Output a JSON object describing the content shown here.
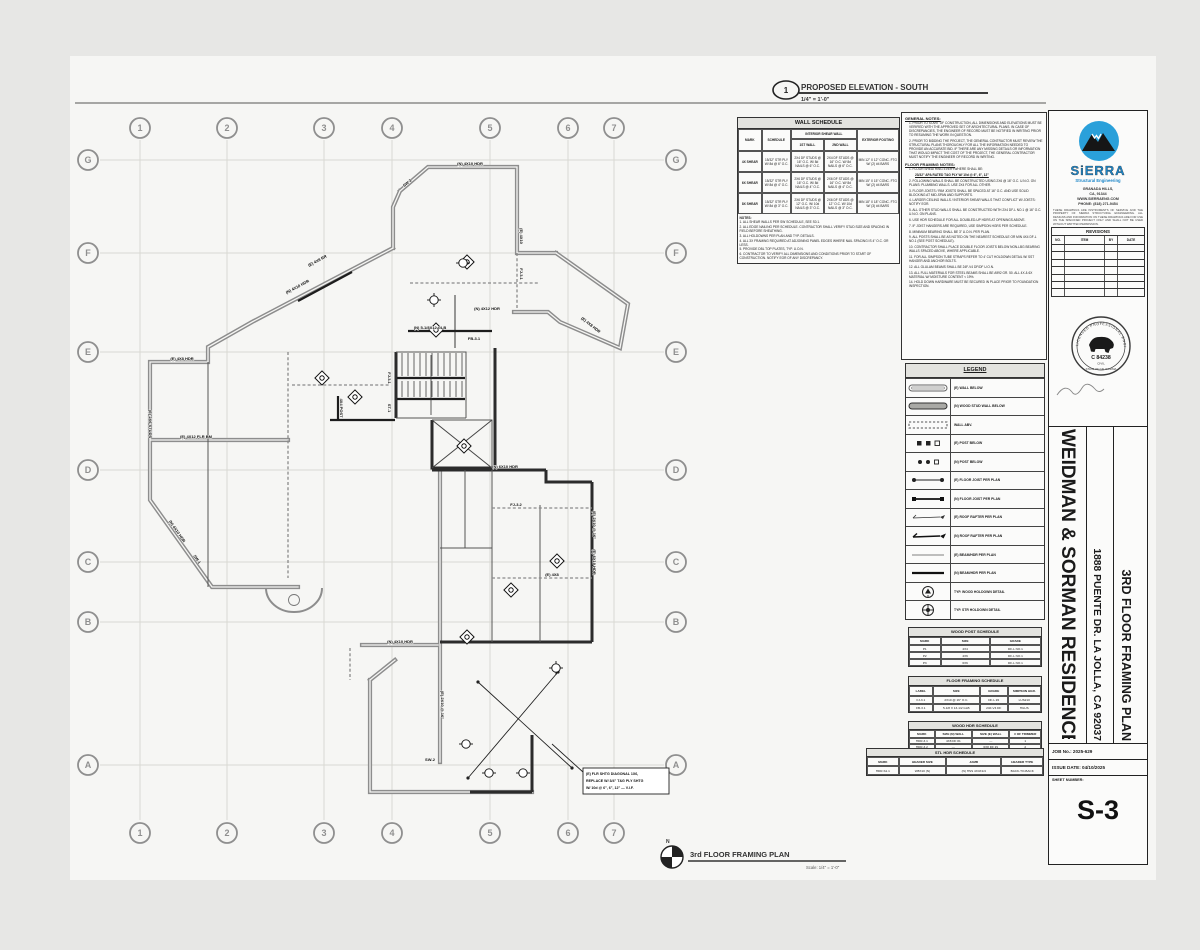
{
  "colors": {
    "logo_blue": "#2aa0da",
    "wall_gray": "#8d8d8d",
    "paper": "#f6f6f4"
  },
  "top_label": {
    "bubble": "1",
    "title": "PROPOSED ELEVATION - SOUTH",
    "scale": "1/4\" = 1'-0\""
  },
  "plan_label": {
    "north": "N",
    "title": "3rd FLOOR FRAMING PLAN",
    "scale": "Scale: 1/4\" = 1'-0\""
  },
  "grid": {
    "columns": [
      "1",
      "2",
      "3",
      "4",
      "5",
      "6",
      "7"
    ],
    "rows": [
      "G",
      "F",
      "E",
      "D",
      "C",
      "B",
      "A"
    ]
  },
  "wall_schedule": {
    "title": "WALL SCHEDULE",
    "col_mark": "MARK",
    "col_schedule": "SCHEDULE",
    "col_interior": "INTERIOR SHEAR WALL",
    "col_int1": "1ST WALL",
    "col_int2": "2ND WALL",
    "col_exterior": "EXTERIOR FOOTING",
    "rows": [
      {
        "mark": "4X SHEAR",
        "schedule": "15/32\" STR PLY W/ 8d @ 6\" O.C.",
        "int1": "2X4 DF STUDS @ 16\" O.C. W/ 8d NAILS @ 6\" O.C.",
        "int2": "2X4 DF STUDS @ 16\" O.C. W/ 8d NAILS @ 6\" O.C.",
        "ext": "MIN 12\" X 12\" CONC. FTG W/ (2) #4 BARS"
      },
      {
        "mark": "6X SHEAR",
        "schedule": "15/32\" STR PLY W/ 8d @ 4\" O.C.",
        "int1": "2X6 DF STUDS @ 16\" O.C. W/ 8d NAILS @ 4\" O.C.",
        "int2": "2X6 DF STUDS @ 16\" O.C. W/ 8d NAILS @ 4\" O.C.",
        "ext": "MIN 15\" X 15\" CONC. FTG W/ (2) #4 BARS"
      },
      {
        "mark": "8X SHEAR",
        "schedule": "15/32\" STR PLY W/ 8d @ 3\" O.C.",
        "int1": "2X6 DF STUDS @ 12\" O.C. W/ 10d NAILS @ 3\" O.C.",
        "int2": "2X6 DF STUDS @ 12\" O.C. W/ 10d NAILS @ 3\" O.C.",
        "ext": "MIN 18\" X 18\" CONC. FTG W/ (3) #4 BARS"
      }
    ],
    "notes": [
      "NOTES:",
      "1. ALL SHEAR WALLS PER SW SCHEDULE, SEE S0.1.",
      "2. ALL EDGE NAILING PER SCHEDULE. CONTRACTOR SHALL VERIFY STUD SIZE AND SPACING IN FIELD BEFORE SHEATHING.",
      "3. ALL HOLDOWNS PER PLAN AND TYP. DETAILS.",
      "4. ALL 3X FRAMING REQUIRED AT ADJOINING PANEL EDGES WHERE NAIL SPACING IS 4\" O.C. OR LESS.",
      "5. PROVIDE DBL TOP PLATES, TYP. U.O.N.",
      "6. CONTRACTOR TO VERIFY ALL DIMENSIONS AND CONDITIONS PRIOR TO START OF CONSTRUCTION. NOTIFY EOR OF ANY DISCREPANCY."
    ]
  },
  "general_notes": {
    "title": "GENERAL NOTES:",
    "items": [
      "1.  PRIOR TO START OF CONSTRUCTION, ALL DIMENSIONS AND ELEVATIONS MUST BE VERIFIED WITH THE APPROVED SET OF ARCHITECTURAL PLANS. IN CASE OF DISCREPANCIES, THE ENGINEER OF RECORD MUST BE NOTIFIED IN WRITING PRIOR TO RESUMING THE WORK IN QUESTION.",
      "2.  PRIOR TO BIDDING THE PROJECT, THE GENERAL CONTRACTOR MUST REVIEW THE STRUCTURAL PLANS THOROUGHLY FOR ALL THE INFORMATION NEEDED TO PROVIDE AN ACCURATE BID. IF THERE ARE ANY MISSING DETAILS OR INFORMATION THAT WOULD IMPACT THE COST OF THE PROJECT, THE GENERAL CONTRACTOR MUST NOTIFY THE ENGINEER OF RECORD IN WRITING."
    ],
    "framing_title": "FLOOR FRAMING NOTES:",
    "framing_intro": "1.  FLOOR SHEATHING EVERYWHERE SHALL BE:",
    "framing_spec": "23/32\" APA RATED T&G PLY W/ 10d @ 6\", 6\", 12\"",
    "framing_items": [
      "2.  FOLLOWING WALLS SHALL BE CONSTRUCTED USING 2X6 @ 16\" O.C. U.N.O. ON PLANS: PLUMBING WALLS. USE 2X4 FOR ALL OTHER.",
      "3.  FLOOR JOISTS / RIM JOISTS SHALL BE SPACED AT 16\" O.C. AND USE SOLID BLOCKING AT MID-SPAN AND SUPPORTS.",
      "4.  LARGER CEILING WALLS / INTERIOR SHEAR WALLS THAT CONFLICT W/ JOISTS: NOTIFY EOR.",
      "5.  ALL OTHER STUD WALLS SHALL BE CONSTRUCTED WITH 2X4 DF-L NO.1 @ 16\" O.C. U.N.O. ON PLANS.",
      "6.  USE HDR SCHEDULE FOR ALL DOUBLED-UP HDRS AT OPENINGS ABOVE.",
      "7.  IF JOIST HANGERS ARE REQUIRED, USE SIMPSON HGRS PER SCHEDULE.",
      "8.  MINIMUM BEARING SHALL BE 3\" U.O.N. PER PLAN.",
      "9.  ALL POSTS SHALL BE AS NOTED ON THE NEAREST SCHEDULE OR MIN 4X4 DF-L NO.1 (SEE POST SCHEDULE).",
      "10. CONTRACTOR SHALL PLACE DOUBLE FLOOR JOISTS BELOW NON-LBG BEARING WALLS SPACED ABOVE, WHERE APPLICABLE.",
      "11. FOR ALL SIMPSON TUBE STRAPS REFER TO 4' CUT HOLDOWN DETAIL W/ SST HANGER AND ANCHOR BOLTS.",
      "12. ALL GLULAM BEAMS SHALL BE 24F-V4 DF/DF U.O.N.",
      "13. ALL FULL MATERIALS FOR STEEL BEAMS SHALL BE A992 GR. 50. ALL 4X & 6X MATERIAL W/ MOISTURE CONTENT < 19%.",
      "14. HOLD DOWN HARDWARE MUST BE SECURED IN PLACE PRIOR TO FOUNDATION INSPECTION."
    ]
  },
  "legend": {
    "title": "LEGEND",
    "items": [
      "(E) WALL BELOW",
      "(N) WOOD STUD WALL BELOW",
      "WALL ABV.",
      "(E) POST BELOW",
      "(N) POST BELOW",
      "(E) FLOOR JOIST PER PLAN",
      "(N) FLOOR JOIST PER PLAN",
      "(E) ROOF RAFTER PER PLAN",
      "(N) ROOF RAFTER PER PLAN",
      "(E) BEAM/HDR PER PLAN",
      "(N) BEAM/HDR PER PLAN",
      "TYP. WOOD HOLDOWN DETAIL",
      "TYP. STR HOLDOWN DETAIL"
    ]
  },
  "wood_post_schedule": {
    "title": "WOOD POST SCHEDULE",
    "columns": [
      "MARK",
      "SIZE",
      "GRADE"
    ],
    "rows": [
      [
        "P1",
        "4X4",
        "DF-L NO.1"
      ],
      [
        "P2",
        "4X6",
        "DF-L NO.1"
      ],
      [
        "P3",
        "6X6",
        "DF-L NO.1"
      ]
    ]
  },
  "floor_framing_schedule": {
    "title": "FLOOR FRAMING SCHEDULE",
    "columns": [
      "LABEL",
      "SIZE",
      "GRADE",
      "SIMPSON HGR."
    ],
    "rows": [
      [
        "FJ-3.1",
        "2X10 @ 16\" O.C.",
        "DF-L #2",
        "LUS210"
      ],
      [
        "FB-3.1",
        "5-1/8 X 13-1/2 GLB",
        "24F-V4 DF",
        "HGUS"
      ]
    ]
  },
  "wood_hdr_schedule": {
    "title": "WOOD HDR SCHEDULE",
    "columns": [
      "MARK",
      "SIZE (N) WALL",
      "SIZE (E) WALL",
      "# OF TRIMMER"
    ],
    "rows": [
      [
        "HDR-3.1",
        "4X8 DF #1",
        "—",
        "1"
      ],
      [
        "HDR-3.2",
        "—",
        "6X8 DF #1",
        "2"
      ]
    ]
  },
  "stl_hdr_schedule": {
    "title": "STL HDR SCHEDULE",
    "columns": [
      "MARK",
      "HEADER SIZE",
      "JAMB",
      "HEADER TYPE"
    ],
    "rows": [
      [
        "HDR-S1.1",
        "W8X10 (N)",
        "(N) HSS 4X4X1/4",
        "BACK-TO-BACK"
      ]
    ]
  },
  "title_block": {
    "company": {
      "name": "SiERRA",
      "tagline": "Structural Engineering",
      "address_lines": [
        "GRANADA HILLS,",
        "CA, 91344",
        "WWW.SIERRAENG.COM",
        "PHONE: (818) 271-9454"
      ],
      "disclaimer": "THESE DRAWINGS ARE INSTRUMENTS OF SERVICE AND THE PROPERTY OF SIERRA STRUCTURAL ENGINEERING. ALL DESIGNS AND INFORMATION ON THESE DRAWINGS ARE FOR USE ON THE SPECIFIED PROJECT ONLY AND SHALL NOT BE USED WITHOUT WRITTEN PERMISSION."
    },
    "revisions": {
      "title": "REVISIONS",
      "columns": [
        "NO.",
        "ITEM",
        "BY",
        "DATE"
      ]
    },
    "stamp": {
      "arc_top": "LICENSED PROFESSIONAL ENGINEER",
      "arc_bottom": "STATE OF CALIFORNIA",
      "license": "C 84238",
      "discipline": "CIVIL"
    },
    "project": {
      "client": "WEIDMAN & SORMAN RESIDENCE",
      "address": "1888 PUENTE DR. LA JOLLA, CA 92037",
      "sheet_title": "3RD FLOOR FRAMING PLAN"
    },
    "job_no": "JOB No.: 2025-629",
    "issue_date": "ISSUE DATE: 04/10/2025",
    "sheet_number_label": "SHEET NUMBER:",
    "sheet_number": "S-3"
  },
  "plan": {
    "labels": [
      "(N) 4X10 HDR",
      "(E) 4X8 RR",
      "(E) 4X12 FLR BM",
      "(E) 2X6 STUDS",
      "(N) 4X10 HDR",
      "SW-1",
      "FJ-3.1",
      "ST-1",
      "(N) 5-1/8X12 GLB",
      "FB-3.1",
      "(E) 4X10",
      "FJ-3.1",
      "(N) 4X12 HDR",
      "(E) 4X8 HDR",
      "(N) 6X10 HDR",
      "(E) 2X10 @ 16\"",
      "FJ-3.2",
      "(E) 4X8",
      "(E) 2X10 @ 16\"",
      "(N) 4X10 HDR",
      "SW-2",
      "(E) 4X8 HDR",
      "SW-3",
      "(N) 4X10 HDR",
      "4X4 POST",
      "(E) 6X10 HDR"
    ],
    "note_box": [
      "(E) FLR SHTG DIAGONAL 1X6,",
      "REPLACE W/ 3/4\" T&G PLY SHTG",
      "W/ 10d @ 6\", 6\", 12\" — V.I.F."
    ]
  }
}
